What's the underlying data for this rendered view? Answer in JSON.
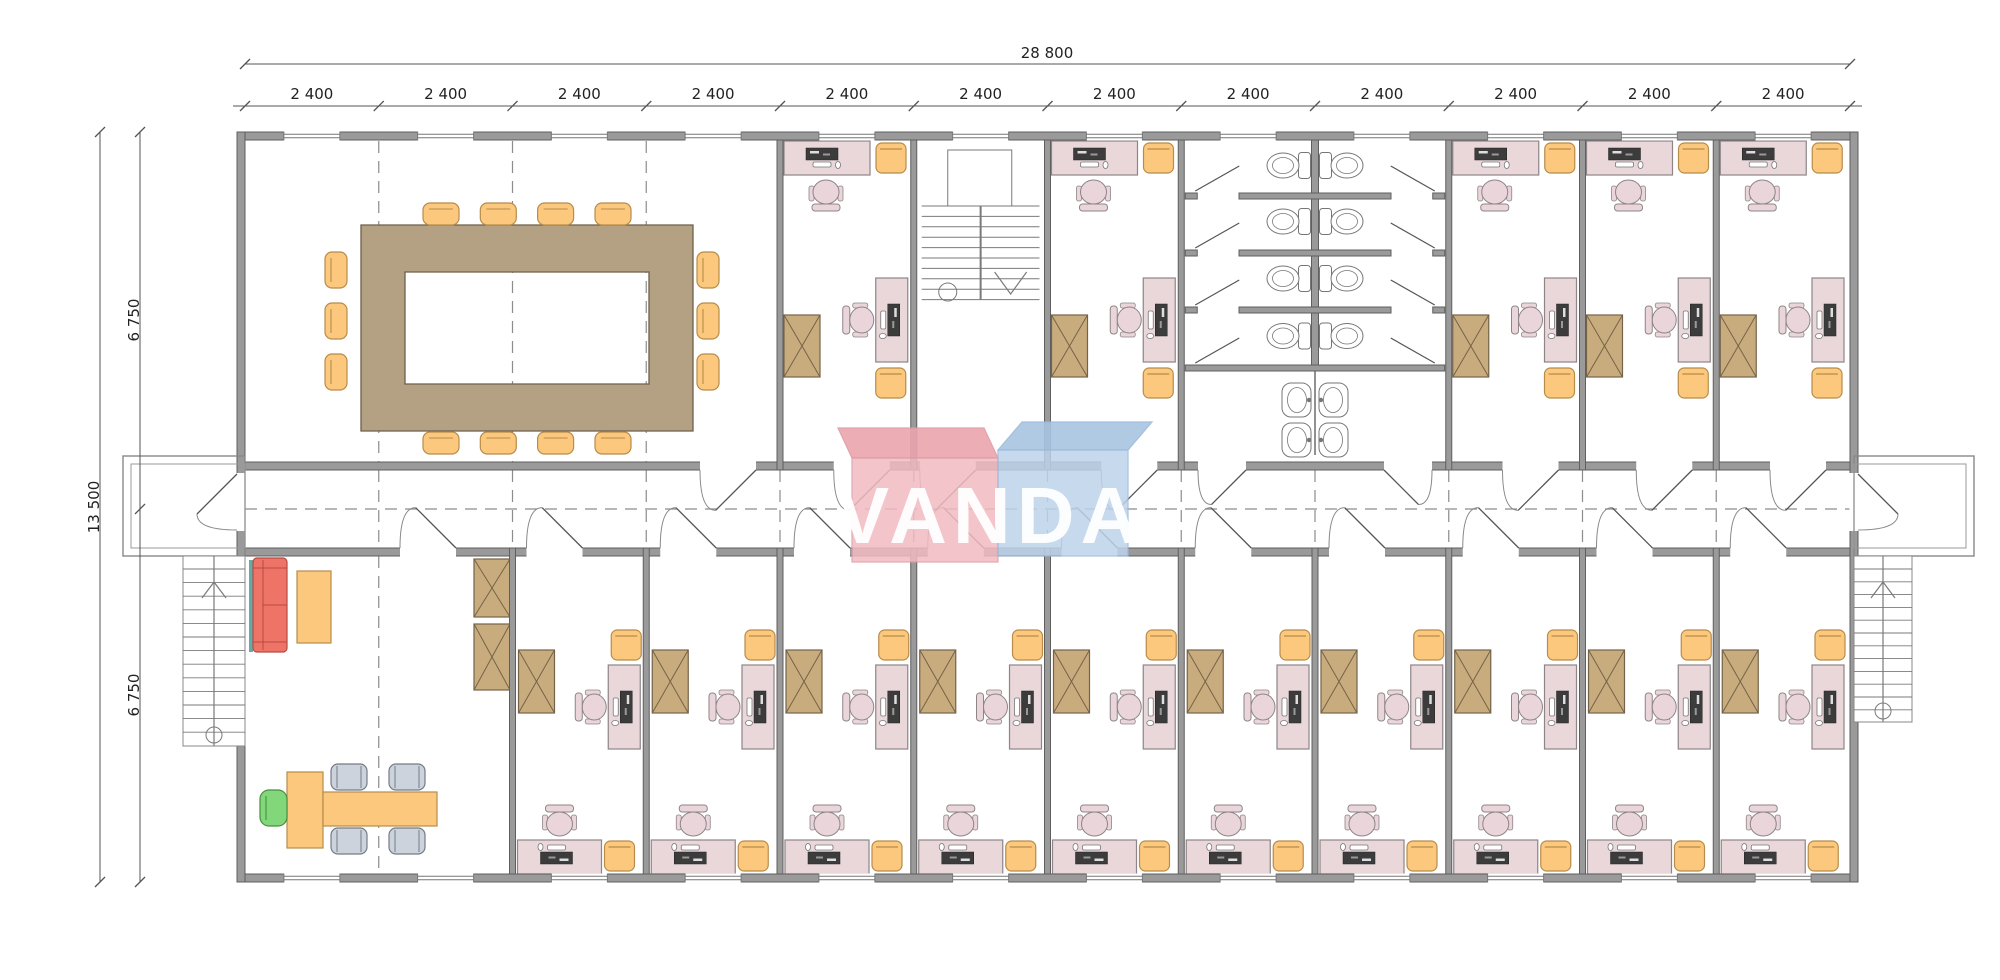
{
  "logo": {
    "text": "VANDA",
    "left_box_color": "#f2bcc3",
    "left_lid_color": "#eca5ae",
    "right_box_color": "#bdd3ea",
    "right_lid_color": "#a8c5e2",
    "left_stroke": "#dc9aa5",
    "right_stroke": "#9ab9dc",
    "text_color": "#ffffff"
  },
  "dimensions": {
    "top_total_label": "28 800",
    "top_segment_labels": [
      "2 400",
      "2 400",
      "2 400",
      "2 400",
      "2 400",
      "2 400",
      "2 400",
      "2 400",
      "2 400",
      "2 400",
      "2 400",
      "2 400"
    ],
    "left_total_label": "13 500",
    "left_segment_labels": [
      "6 750",
      "6 750"
    ]
  },
  "palette": {
    "background": "#ffffff",
    "wall_fill": "#9a9a9a",
    "wall_stroke": "#5f5f5f",
    "line": "#6a6a6a",
    "dash_line": "#8c8c8c",
    "dim_line": "#555555",
    "dim_text": "#222222",
    "desk_fill": "#e9d7da",
    "desk_stroke": "#8d8588",
    "chair_fill": "#ead5da",
    "computer_dark": "#3c3c3c",
    "orange_fill": "#fbc87d",
    "orange_stroke": "#b88c4a",
    "cabinet_fill": "#c9ac7e",
    "cabinet_stroke": "#746348",
    "table_tan_fill": "#b4a184",
    "table_tan_stroke": "#6d5f49",
    "sofa_fill": "#ee7468",
    "sofa_stroke": "#b94a42",
    "teal_strip": "#5fada6",
    "gray_chair_fill": "#ccd3dd",
    "gray_chair_stroke": "#757c86",
    "green_chair_fill": "#82d77b",
    "green_chair_stroke": "#46903f",
    "fixture_stroke": "#767676",
    "stair_line": "#7a7a7a"
  },
  "building": {
    "module_count": 12,
    "office_furniture": {
      "desks": 2,
      "task_chairs": 2,
      "visitor_chairs": 2,
      "cabinets": 1,
      "computers": 2
    },
    "rooms_top": [
      {
        "type": "conference-room",
        "modules": 4,
        "chairs": 14,
        "tables": 1
      },
      {
        "type": "office",
        "modules": 1
      },
      {
        "type": "stairwell",
        "modules": 1
      },
      {
        "type": "office",
        "modules": 1
      },
      {
        "type": "wc",
        "modules": 2,
        "toilet_stalls": 8,
        "sinks": 4
      },
      {
        "type": "office",
        "modules": 1
      },
      {
        "type": "office",
        "modules": 1
      },
      {
        "type": "office",
        "modules": 1
      }
    ],
    "rooms_bottom": [
      {
        "type": "reception",
        "modules": 2,
        "sofas": 1,
        "coffee_tables": 1,
        "meeting_tables": 1,
        "meeting_chairs": 4,
        "armchairs": 1,
        "cabinets": 2
      },
      {
        "type": "office",
        "modules": 1
      },
      {
        "type": "office",
        "modules": 1
      },
      {
        "type": "office",
        "modules": 1
      },
      {
        "type": "office",
        "modules": 1
      },
      {
        "type": "office",
        "modules": 1
      },
      {
        "type": "office",
        "modules": 1
      },
      {
        "type": "office",
        "modules": 1
      },
      {
        "type": "office",
        "modules": 1
      },
      {
        "type": "office",
        "modules": 1
      },
      {
        "type": "office",
        "modules": 1
      }
    ],
    "exterior_stairs": 2,
    "windows_top": 12,
    "windows_bottom": 12
  }
}
